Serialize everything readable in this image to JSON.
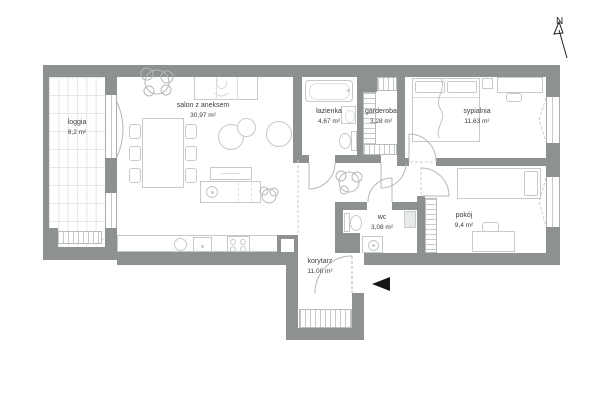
{
  "compass": {
    "label": "N"
  },
  "rooms": [
    {
      "id": "loggia",
      "name": "loggia",
      "area": "8,2 m²"
    },
    {
      "id": "salon",
      "name": "salon z aneksem",
      "area": "30,97 m²"
    },
    {
      "id": "lazienka",
      "name": "łazienka",
      "area": "4,67 m²"
    },
    {
      "id": "garderoba",
      "name": "garderoba",
      "area": "3,28 m²"
    },
    {
      "id": "sypialnia",
      "name": "sypialnia",
      "area": "11,63 m²"
    },
    {
      "id": "wc",
      "name": "wc",
      "area": "3,08 m²"
    },
    {
      "id": "pokoj",
      "name": "pokój",
      "area": "9,4 m²"
    },
    {
      "id": "korytarz",
      "name": "korytarz",
      "area": "11,08 m²"
    }
  ],
  "markers": {
    "entrance": "entrance-arrow",
    "north": "north-arrow"
  },
  "colors": {
    "wall": "#8d9192",
    "furniture_line": "#c6caca",
    "hatch": "#b9bdbd",
    "text": "#3a3e3e",
    "entrance_marker": "#161616",
    "background": "#ffffff"
  }
}
